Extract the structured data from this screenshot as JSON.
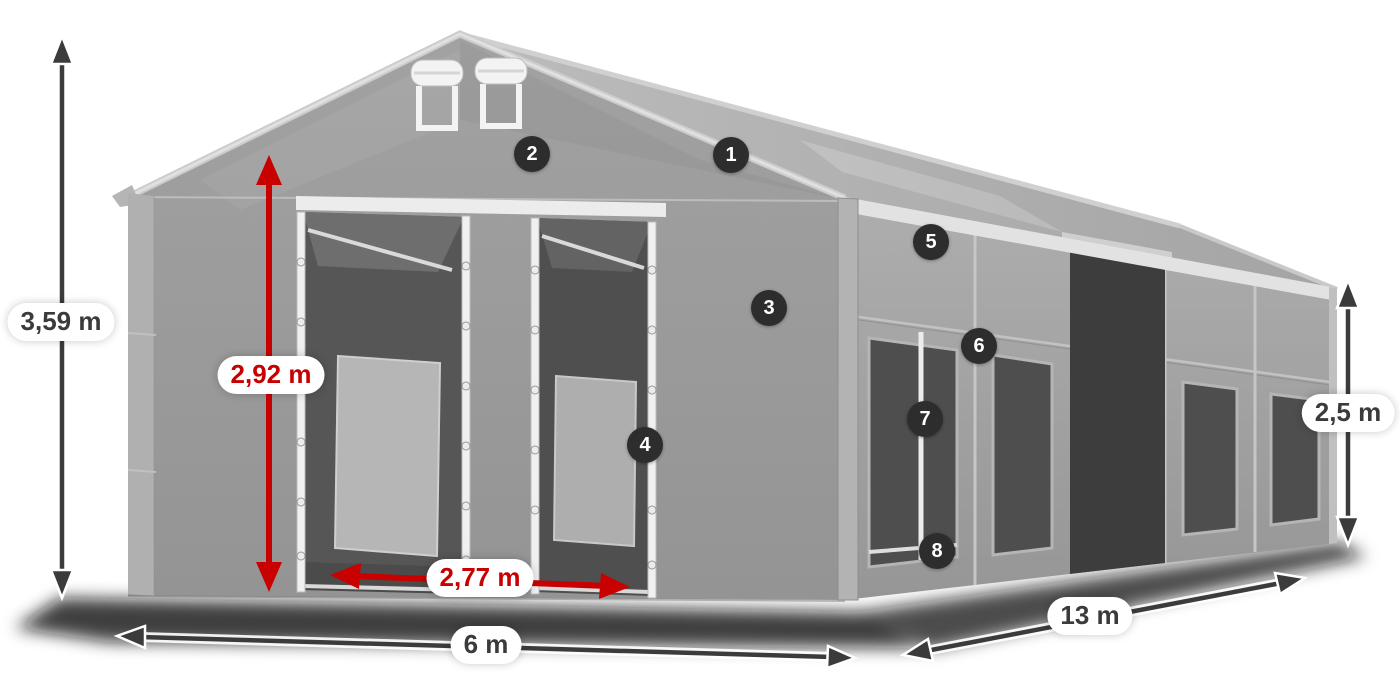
{
  "diagram": {
    "dimensions": {
      "total_height": "3,59 m",
      "entrance_height": "2,92 m",
      "entrance_width": "2,77 m",
      "front_width": "6 m",
      "side_length": "13 m",
      "side_height": "2,5 m"
    },
    "callouts": [
      "1",
      "2",
      "3",
      "4",
      "5",
      "6",
      "7",
      "8"
    ],
    "colors": {
      "red_accent": "#c90000",
      "arrow_dark": "#3b3b3b",
      "badge_background": "#2d2d2d",
      "tent_gray": "#9e9e9e"
    }
  }
}
